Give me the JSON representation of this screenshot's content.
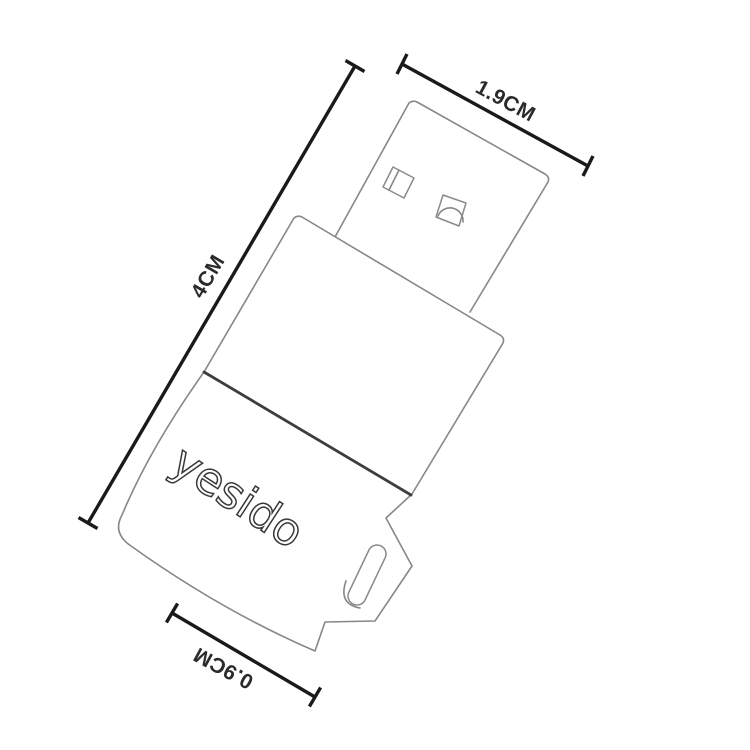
{
  "canvas": {
    "background": "#ffffff"
  },
  "device": {
    "brand_logo": "yesido"
  },
  "dimensions": {
    "width_label": "1.9CM",
    "length_label": "4CM",
    "tail_label": "0.9CM"
  },
  "colors": {
    "outline_gray": "#878787",
    "seam_dark": "#3d3d3d",
    "dimension_black": "#1a1a1a",
    "label_text": "#2b2b2b",
    "logo_stroke": "#383838"
  }
}
